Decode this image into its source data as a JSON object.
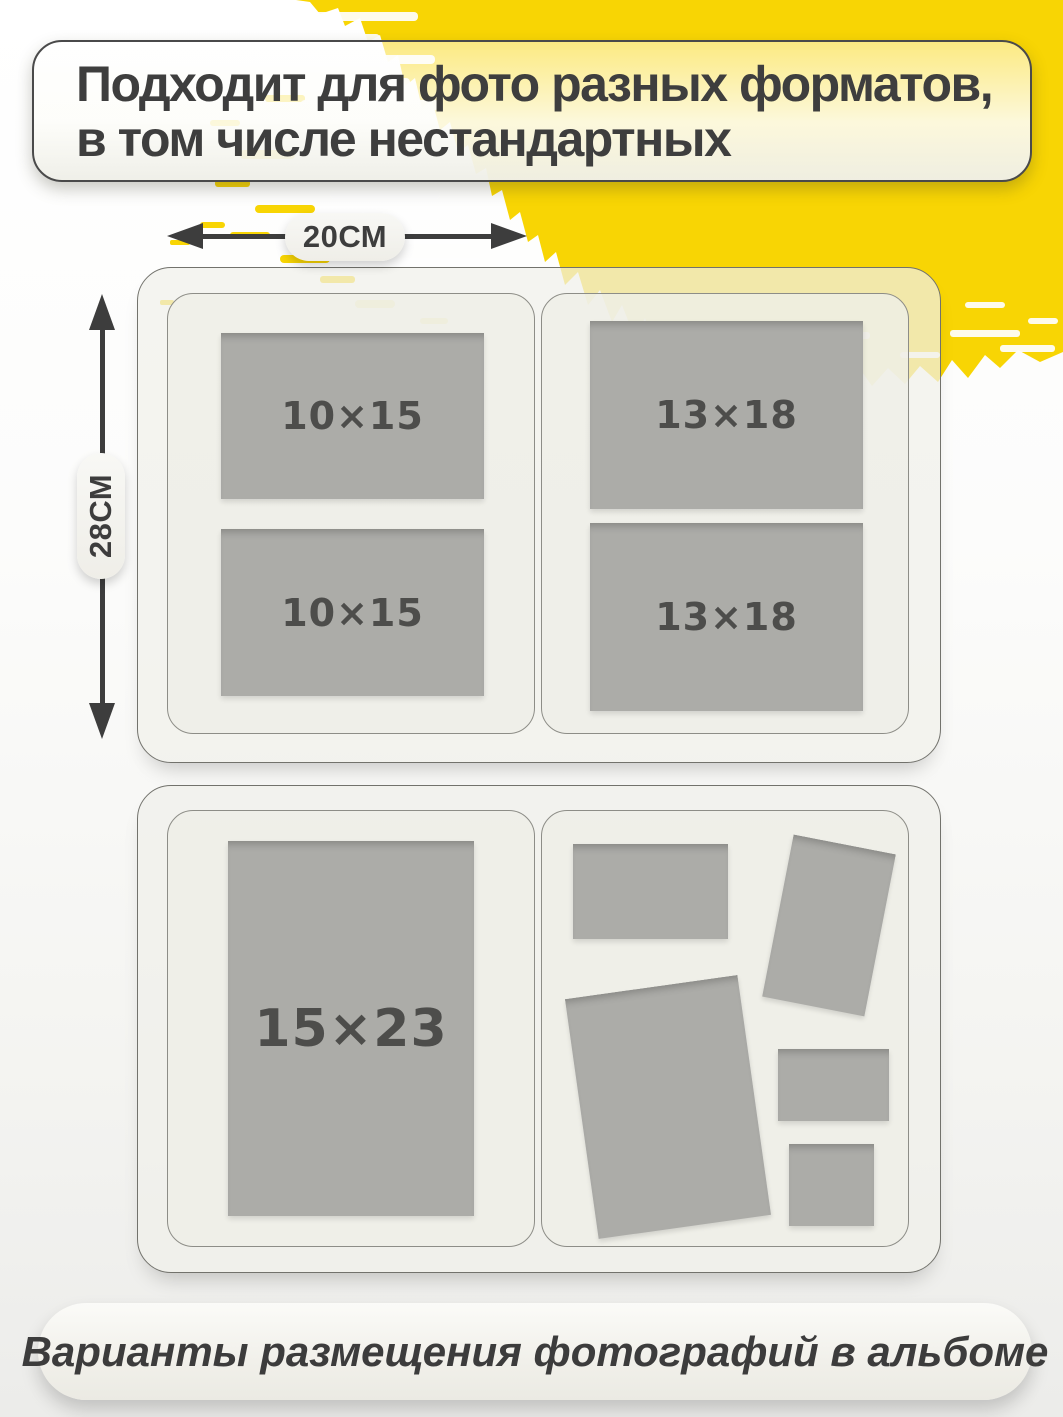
{
  "title": {
    "line1": "Подходит для фото разных форматов,",
    "line2": "в том числе нестандартных"
  },
  "dimensions": {
    "width": "20см",
    "height": "28см"
  },
  "album": {
    "top_spread": {
      "left_page": {
        "photos": [
          {
            "label": "10×15"
          },
          {
            "label": "10×15"
          }
        ]
      },
      "right_page": {
        "photos": [
          {
            "label": "13×18"
          },
          {
            "label": "13×18"
          }
        ]
      }
    },
    "bottom_spread": {
      "left_page": {
        "photos": [
          {
            "label": "15×23"
          }
        ]
      },
      "right_page": {
        "photo_count": 5
      }
    }
  },
  "caption": "Варианты размещения фотографий в альбоме",
  "colors": {
    "brush_yellow": "#F8D504",
    "text_dark": "#3E3E3E",
    "photo_gray": "#ACACA8",
    "page_bg": "#EFEFE9"
  }
}
